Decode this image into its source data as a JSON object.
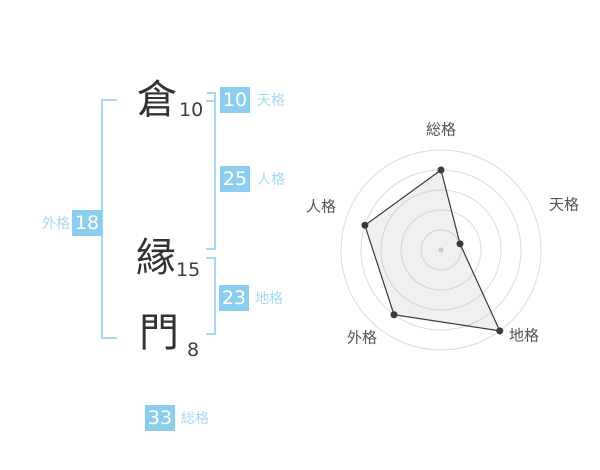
{
  "page": {
    "background": "#ffffff"
  },
  "name_panel": {
    "characters": [
      {
        "char": "倉",
        "strokes": "10"
      },
      {
        "char": "縁",
        "strokes": "15"
      },
      {
        "char": "門",
        "strokes": "8"
      }
    ],
    "badges": {
      "tenkaku": {
        "value": "10",
        "label": "天格"
      },
      "jinkaku": {
        "value": "25",
        "label": "人格"
      },
      "chikaku": {
        "value": "23",
        "label": "地格"
      },
      "gaikaku": {
        "value": "18",
        "label": "外格"
      },
      "soukaku": {
        "value": "33",
        "label": "総格"
      }
    },
    "colors": {
      "badge_bg": "#8cceef",
      "badge_text": "#ffffff",
      "label_text": "#a9d8f2",
      "bracket": "#a9d8f2",
      "kanji": "#333333",
      "stroke_num": "#3f3f3f"
    }
  },
  "chart_data": {
    "type": "radar",
    "axes": [
      "総格",
      "天格",
      "地格",
      "外格",
      "人格"
    ],
    "values": [
      4,
      1,
      5,
      4,
      4
    ],
    "max": 5,
    "rings": 5,
    "grid": "concentric-circles",
    "legend": "none",
    "colors": {
      "ring": "#dcdcdc",
      "polygon_stroke": "#3a3a3a",
      "polygon_fill": "rgba(160,160,160,0.16)",
      "point": "#3a3a3a",
      "center_dot": "#c9c9c9",
      "axis_label": "#555555"
    }
  }
}
